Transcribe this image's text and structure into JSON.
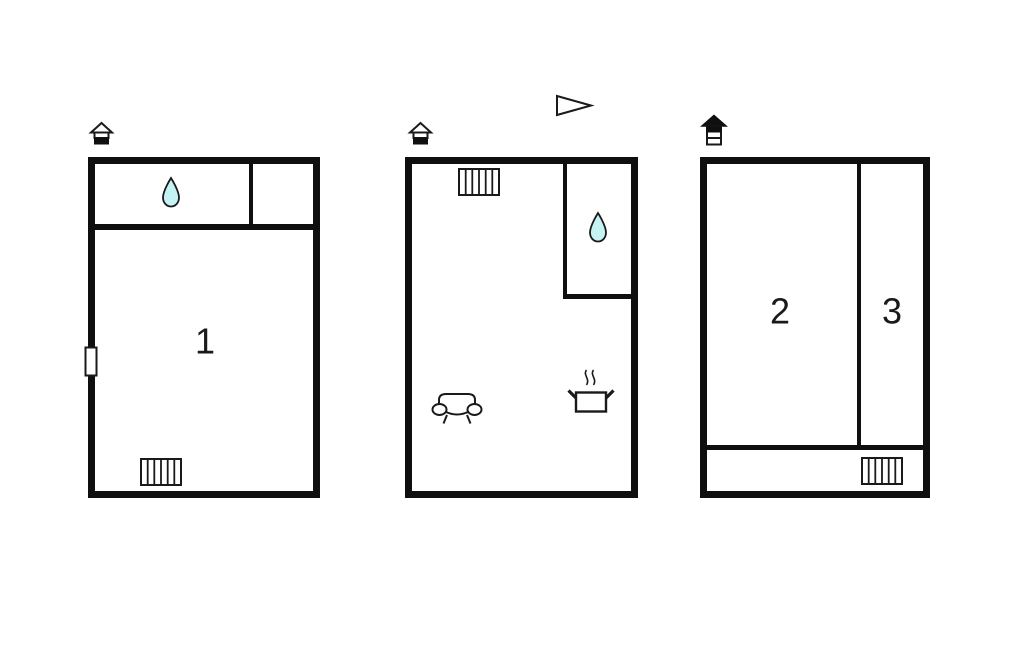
{
  "figure": {
    "type": "floor-plan",
    "description": "Three schematic floor plans of a holiday property"
  },
  "colors": {
    "background": "#ffffff",
    "wall": "#0f0f0f",
    "line": "#1a1a1a",
    "water_drop_fill": "#c5f2f2"
  },
  "labels": {
    "room1": "1",
    "room2": "2",
    "room3": "3"
  },
  "plans": [
    {
      "position": "left",
      "room_labels": [
        "1"
      ],
      "icons": [
        "house-icon",
        "water-drop-icon",
        "window-marker",
        "radiator-icon"
      ]
    },
    {
      "position": "middle",
      "room_labels": [],
      "icons": [
        "house-icon",
        "direction-arrow-icon",
        "radiator-icon",
        "water-drop-icon",
        "sofa-icon",
        "stove-pot-icon"
      ]
    },
    {
      "position": "right",
      "room_labels": [
        "2",
        "3"
      ],
      "icons": [
        "multi-storey-house-icon",
        "radiator-icon"
      ]
    }
  ]
}
